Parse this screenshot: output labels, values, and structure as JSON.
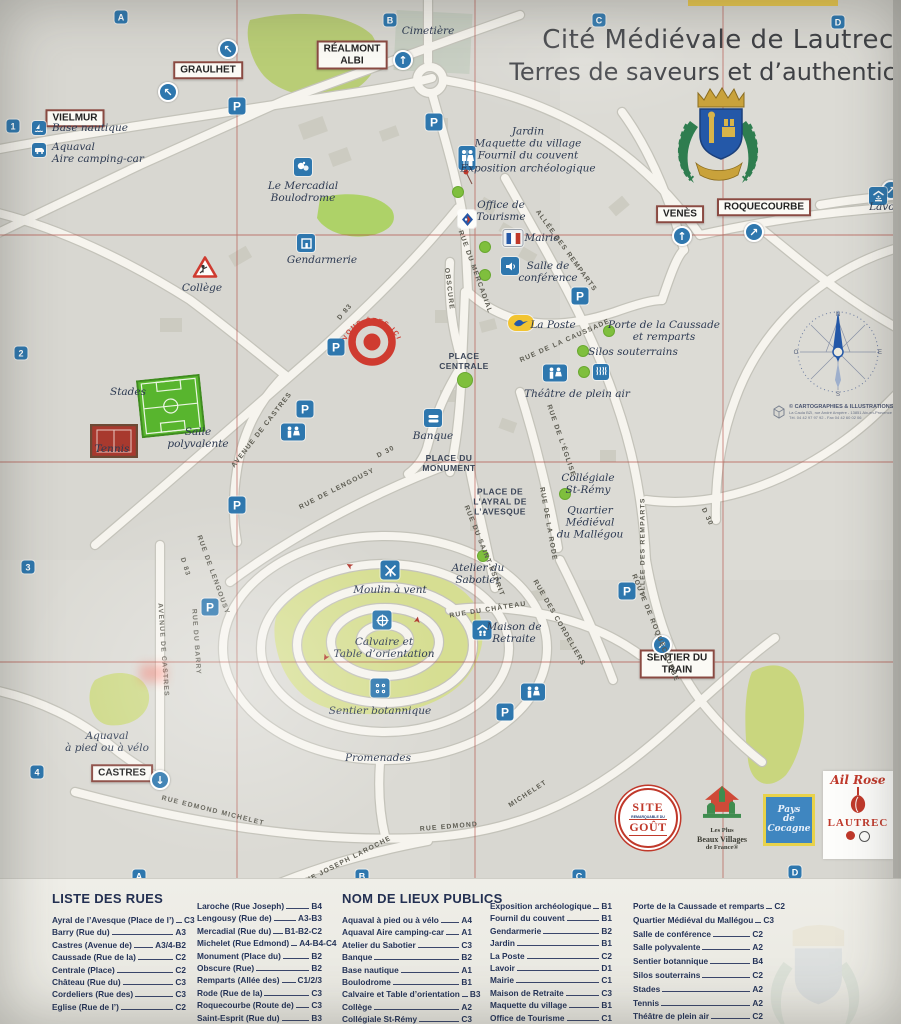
{
  "title": {
    "line1": "Cité Médiévale de Lautrec",
    "line2": "Terres de saveurs et d’authenticité"
  },
  "grid": {
    "top": [
      "A",
      "B",
      "C",
      "D"
    ],
    "bottom": [
      "A",
      "B",
      "C",
      "D"
    ],
    "left": [
      "1",
      "2",
      "3",
      "4"
    ]
  },
  "colors": {
    "marker_blue": "#2e77ae",
    "grid_red": "#b0443a",
    "green_poi": "#7fbf3d",
    "sign_border": "#8a4a42",
    "target_red": "#cf3b30",
    "poste_yellow": "#f2c431"
  },
  "you_are_here": "VOUS ÊTES ICI",
  "compass": {
    "n": "N",
    "s": "S",
    "e": "E",
    "o": "O"
  },
  "icons": {
    "parking_label": "P"
  },
  "signs": {
    "vielmur": "VIELMUR",
    "graulhet": "GRAULHET",
    "realmont": "RÉALMONT\nALBI",
    "venes": "VENÈS",
    "roquecourbe": "ROQUECOURBE",
    "castres": "CASTRES",
    "sentier_train": "SENTIER DU\nTRAIN"
  },
  "map": {
    "labels": {
      "cimetiere": "Cimetière",
      "base_nautique": "Base nautique",
      "aquaval_camping": "Aquaval\nAire camping-car",
      "mercadial": "Le Mercadial\nBoulodrome",
      "gendarmerie": "Gendarmerie",
      "college": "Collège",
      "jardin_group": "Jardin\nMaquette du village\nFournil du couvent\nExposition archéologique",
      "office_tourisme": "Office de\nTourisme",
      "mairie": "Mairie",
      "salle_conference": "Salle de\nconférence",
      "la_poste": "La Poste",
      "porte_caussade": "Porte de la Caussade\net remparts",
      "silos": "Silos souterrains",
      "theatre": "Théâtre de plein air",
      "banque": "Banque",
      "stades": "Stades",
      "salle_polyvalente": "Salle\npolyvalente",
      "tennis": "Tennis",
      "collegiale": "Collégiale\nSt-Rémy",
      "quartier": "Quartier\nMédiéval\ndu Mallégou",
      "atelier": "Atelier du\nSabotier",
      "moulin": "Moulin à vent",
      "calvaire": "Calvaire et\nTable d’orientation",
      "maison_retraite": "Maison de\nRetraite",
      "sentier_botannique": "Sentier botannique",
      "promenades": "Promenades",
      "aquaval_velo": "Aquaval\nà pied ou à vélo",
      "lavoir": "Lavoir"
    },
    "places_caps": {
      "place_centrale": "PLACE\nCENTRALE",
      "place_monument": "PLACE DU\nMONUMENT",
      "place_ayral": "PLACE DE\nL’AYRAL DE\nL’AVESQUE"
    },
    "streets": {
      "avenue_castres": "AVENUE DE CASTRES",
      "d83": "D 83",
      "d30": "D 30",
      "lengousy": "RUE DE LENGOUSY",
      "barry": "RUE DU BARRY",
      "mercadial_rue": "RUE DU MERCADIAL",
      "obscure": "OBSCURE",
      "caussade_rue": "RUE DE LA CAUSSADE",
      "remparts_allee": "ALLÉE DES REMPARTS",
      "eglise_rue": "RUE DE L’ÉGLISE",
      "saint_esprit": "RUE DU SAINT-ESPRIT",
      "rode": "RUE DE LA RODE",
      "chateau": "RUE DU CHÂTEAU",
      "cordeliers": "RUE DES CORDELIERS",
      "roquecourbe_route": "ROUTE DE ROQUECOURBE",
      "michelet_1": "RUE EDMOND MICHELET",
      "rue_edmond": "RUE  EDMOND",
      "michelet_2": "MICHELET",
      "laroche": "RUE JOSEPH LAROCHE"
    }
  },
  "credit": {
    "line1": "© CARTOGRAPHIES & ILLUSTRATIONS",
    "line2": "La Caula BZI, rue André Ampère - 13851 Aix-en-Provence",
    "line3": "Tél. 04 42 97 97 92 - Fax 04 42 60 02 06"
  },
  "logos": {
    "site_gout": {
      "top": "SITE",
      "mid": "REMARQUABLE DU",
      "bottom": "GOÛT"
    },
    "beaux_villages": {
      "line1": "Les Plus",
      "line2": "Beaux Villages",
      "line3": "de France®"
    },
    "pays_cocagne": {
      "line1": "Pays",
      "line2": "de",
      "line3": "Cocagne"
    },
    "ail_rose": {
      "script": "Ail Rose",
      "name": "LAUTREC"
    }
  },
  "legend": {
    "streets": {
      "title": "LISTE DES RUES",
      "col1": [
        {
          "name": "Ayral de l’Avesque (Place de l’)",
          "ref": "C3"
        },
        {
          "name": "Barry (Rue du)",
          "ref": "A3"
        },
        {
          "name": "Castres (Avenue de)",
          "ref": "A3/4-B2"
        },
        {
          "name": "Caussade (Rue de la)",
          "ref": "C2"
        },
        {
          "name": "Centrale (Place)",
          "ref": "C2"
        },
        {
          "name": "Château (Rue du)",
          "ref": "C3"
        },
        {
          "name": "Cordeliers (Rue des)",
          "ref": "C3"
        },
        {
          "name": "Eglise (Rue de l’)",
          "ref": "C2"
        }
      ],
      "col2": [
        {
          "name": "Laroche (Rue Joseph)",
          "ref": "B4"
        },
        {
          "name": "Lengousy (Rue de)",
          "ref": "A3-B3"
        },
        {
          "name": "Mercadial (Rue du)",
          "ref": "B1-B2-C2"
        },
        {
          "name": "Michelet (Rue Edmond)",
          "ref": "A4-B4-C4"
        },
        {
          "name": "Monument (Place du)",
          "ref": "B2"
        },
        {
          "name": "Obscure (Rue)",
          "ref": "B2"
        },
        {
          "name": "Remparts (Allée des)",
          "ref": "C1/2/3"
        },
        {
          "name": "Rode (Rue de la)",
          "ref": "C3"
        },
        {
          "name": "Roquecourbe (Route de)",
          "ref": "C3"
        },
        {
          "name": "Saint-Esprit (Rue du)",
          "ref": "B3"
        }
      ]
    },
    "places": {
      "title": "NOM DE LIEUX PUBLICS",
      "col1": [
        {
          "name": "Aquaval à pied ou à vélo",
          "ref": "A4"
        },
        {
          "name": "Aquaval Aire camping-car",
          "ref": "A1"
        },
        {
          "name": "Atelier du Sabotier",
          "ref": "C3"
        },
        {
          "name": "Banque",
          "ref": "B2"
        },
        {
          "name": "Base nautique",
          "ref": "A1"
        },
        {
          "name": "Boulodrome",
          "ref": "B1"
        },
        {
          "name": "Calvaire et Table d’orientation",
          "ref": "B3"
        },
        {
          "name": "Collège",
          "ref": "A2"
        },
        {
          "name": "Collégiale St-Rémy",
          "ref": "C3"
        }
      ],
      "col2": [
        {
          "name": "Exposition archéologique",
          "ref": "B1"
        },
        {
          "name": "Fournil du couvent",
          "ref": "B1"
        },
        {
          "name": "Gendarmerie",
          "ref": "B2"
        },
        {
          "name": "Jardin",
          "ref": "B1"
        },
        {
          "name": "La Poste",
          "ref": "C2"
        },
        {
          "name": "Lavoir",
          "ref": "D1"
        },
        {
          "name": "Mairie",
          "ref": "C1"
        },
        {
          "name": "Maison de Retraite",
          "ref": "C3"
        },
        {
          "name": "Maquette du village",
          "ref": "B1"
        },
        {
          "name": "Office de Tourisme",
          "ref": "C1"
        }
      ],
      "col3": [
        {
          "name": "Porte de la Caussade et remparts",
          "ref": "C2"
        },
        {
          "name": "Quartier Médiéval du Mallégou",
          "ref": "C3"
        },
        {
          "name": "Salle de conférence",
          "ref": "C2"
        },
        {
          "name": "Salle polyvalente",
          "ref": "A2"
        },
        {
          "name": "Sentier botannique",
          "ref": "B4"
        },
        {
          "name": "Silos souterrains",
          "ref": "C2"
        },
        {
          "name": "Stades",
          "ref": "A2"
        },
        {
          "name": "Tennis",
          "ref": "A2"
        },
        {
          "name": "Théâtre de plein air",
          "ref": "C2"
        }
      ]
    }
  }
}
